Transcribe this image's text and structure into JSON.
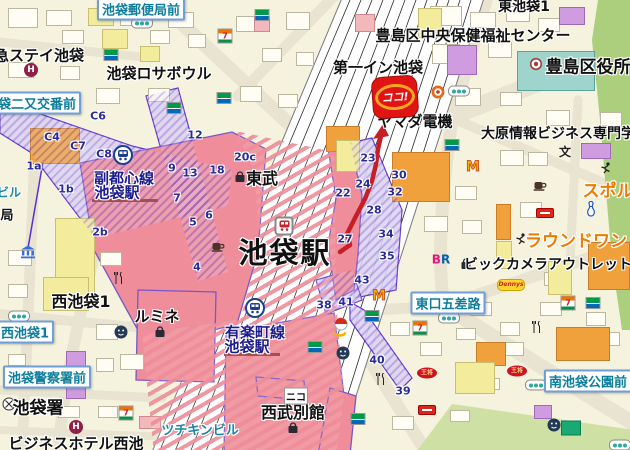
{
  "map": {
    "colors": {
      "route": "#c41f26",
      "marker_red": "#e01413",
      "station_pink": "#ef8e9a",
      "walkway_purple": "#5b2fd0",
      "road_sign_blue": "#6f9fd8",
      "sign_text": "#0c7d9c",
      "green_area": "#abcf7d",
      "orange_building": "#f0a13c"
    },
    "marker": {
      "label": "ココ!"
    },
    "route": {
      "color": "#c41f26",
      "points": "340,252 350,245 347,234 355,218 365,199 372,181 376,164 378,149 381,136",
      "arrow": "383,124 373,139 389,136"
    },
    "signboards": [
      {
        "t": "池袋郵便局前",
        "x": 141,
        "y": 9
      },
      {
        "t": "袋二又交番前",
        "x": 37,
        "y": 103
      },
      {
        "t": "西池袋1",
        "x": 25,
        "y": 332
      },
      {
        "t": "池袋警察署前",
        "x": 47,
        "y": 377
      },
      {
        "t": "東口五差路",
        "x": 448,
        "y": 303
      },
      {
        "t": "南池袋公園前",
        "x": 588,
        "y": 381
      }
    ],
    "labels": [
      {
        "t": "急ステイ池袋",
        "x": 39,
        "y": 55,
        "s": "b15",
        "id": "hotel-tokyu-stay-label"
      },
      {
        "t": "池袋ロサボウル",
        "x": 159,
        "y": 73,
        "s": "b15",
        "id": "rosa-bowl-label"
      },
      {
        "t": "第一イン池袋",
        "x": 378,
        "y": 67,
        "s": "b15",
        "id": "daiichi-inn-label"
      },
      {
        "t": "豊島区中央保健福祉センター",
        "x": 473,
        "y": 35,
        "s": "b15",
        "id": "health-center-label"
      },
      {
        "t": "東池袋1",
        "x": 524,
        "y": 6,
        "s": "b14",
        "id": "higashi-ikebukuro-label"
      },
      {
        "t": "豊島区役所",
        "x": 588,
        "y": 65,
        "s": "b17",
        "id": "toshima-ward-office-label"
      },
      {
        "t": "大原情報ビジネス専門学",
        "x": 558,
        "y": 133,
        "s": "b14",
        "id": "ohara-college-label"
      },
      {
        "t": "ヤマダ電機",
        "x": 415,
        "y": 121,
        "s": "b15",
        "id": "yamada-denki-label"
      },
      {
        "t": "東武",
        "x": 262,
        "y": 177,
        "s": "b16",
        "id": "tobu-label"
      },
      {
        "t": "池袋駅",
        "x": 285,
        "y": 251,
        "s": "xl",
        "id": "ikebukuro-station-label"
      },
      {
        "t": "副都心線",
        "x": 124,
        "y": 178,
        "s": "navy",
        "id": "fukutoshin-line-label"
      },
      {
        "t": "池袋駅",
        "x": 117,
        "y": 192,
        "s": "navy",
        "id": "fukutoshin-station-label"
      },
      {
        "t": "有楽町線",
        "x": 255,
        "y": 332,
        "s": "navy",
        "id": "yurakucho-line-label"
      },
      {
        "t": "池袋駅",
        "x": 247,
        "y": 346,
        "s": "navy",
        "id": "yurakucho-station-label"
      },
      {
        "t": "西池袋1",
        "x": 81,
        "y": 300,
        "s": "b16",
        "id": "nishi-ikebukuro-label"
      },
      {
        "t": "ルミネ",
        "x": 157,
        "y": 316,
        "s": "b15",
        "id": "lumine-label"
      },
      {
        "t": "西武別館",
        "x": 293,
        "y": 411,
        "s": "b16",
        "id": "seibu-annex-label"
      },
      {
        "t": "池袋署",
        "x": 38,
        "y": 406,
        "s": "b17",
        "id": "police-station-label"
      },
      {
        "t": "ビジネスホテル西池",
        "x": 76,
        "y": 443,
        "s": "b15",
        "id": "business-hotel-label"
      },
      {
        "t": "ツチキンビル",
        "x": 200,
        "y": 429,
        "s": "teal13",
        "id": "tsuchikin-bldg-label"
      },
      {
        "t": "ビル",
        "x": 9,
        "y": 192,
        "s": "teal12"
      },
      {
        "t": "局",
        "x": 7,
        "y": 214,
        "s": "b13"
      },
      {
        "t": "ニコ",
        "x": 296,
        "y": 396,
        "s": "chip"
      },
      {
        "t": "スポル",
        "x": 608,
        "y": 189,
        "s": "or17",
        "id": "sporto-label"
      },
      {
        "t": "ラウンドワン",
        "x": 576,
        "y": 239,
        "s": "or17",
        "id": "round-one-label"
      },
      {
        "t": "ビックカメラアウトレット",
        "x": 548,
        "y": 264,
        "s": "b14",
        "id": "bic-camera-outlet-label"
      }
    ],
    "exits": [
      {
        "t": "C6",
        "x": 98,
        "y": 116
      },
      {
        "t": "C4",
        "x": 52,
        "y": 137
      },
      {
        "t": "C7",
        "x": 78,
        "y": 146
      },
      {
        "t": "C8",
        "x": 104,
        "y": 154
      },
      {
        "t": "1a",
        "x": 34,
        "y": 166
      },
      {
        "t": "1b",
        "x": 66,
        "y": 189
      },
      {
        "t": "2b",
        "x": 100,
        "y": 232
      },
      {
        "t": "12",
        "x": 195,
        "y": 135
      },
      {
        "t": "9",
        "x": 172,
        "y": 168
      },
      {
        "t": "13",
        "x": 190,
        "y": 173
      },
      {
        "t": "7",
        "x": 177,
        "y": 198
      },
      {
        "t": "6",
        "x": 209,
        "y": 215
      },
      {
        "t": "5",
        "x": 193,
        "y": 222
      },
      {
        "t": "4",
        "x": 197,
        "y": 267
      },
      {
        "t": "18",
        "x": 217,
        "y": 170
      },
      {
        "t": "20c",
        "x": 245,
        "y": 157
      },
      {
        "t": "23",
        "x": 368,
        "y": 158
      },
      {
        "t": "24",
        "x": 363,
        "y": 184
      },
      {
        "t": "22",
        "x": 343,
        "y": 193
      },
      {
        "t": "28",
        "x": 374,
        "y": 210
      },
      {
        "t": "30",
        "x": 399,
        "y": 175
      },
      {
        "t": "32",
        "x": 395,
        "y": 192
      },
      {
        "t": "27",
        "x": 345,
        "y": 239
      },
      {
        "t": "34",
        "x": 386,
        "y": 234
      },
      {
        "t": "35",
        "x": 387,
        "y": 256
      },
      {
        "t": "43",
        "x": 362,
        "y": 280
      },
      {
        "t": "41",
        "x": 346,
        "y": 302
      },
      {
        "t": "38",
        "x": 324,
        "y": 305
      },
      {
        "t": "40",
        "x": 377,
        "y": 360
      },
      {
        "t": "39",
        "x": 403,
        "y": 391
      }
    ],
    "icons": [
      {
        "type": "traffic-signal",
        "x": 142,
        "y": 23
      },
      {
        "type": "traffic-signal",
        "x": 19,
        "y": 316
      },
      {
        "type": "traffic-signal",
        "x": 459,
        "y": 91
      },
      {
        "type": "traffic-signal",
        "x": 449,
        "y": 318
      },
      {
        "type": "traffic-signal",
        "x": 536,
        "y": 385
      },
      {
        "type": "traffic-signal",
        "x": 620,
        "y": 445
      },
      {
        "type": "seven-eleven",
        "x": 225,
        "y": 36
      },
      {
        "type": "seven-eleven",
        "x": 568,
        "y": 303
      },
      {
        "type": "seven-eleven",
        "x": 420,
        "y": 328
      },
      {
        "type": "seven-eleven",
        "x": 126,
        "y": 413
      },
      {
        "type": "familymart",
        "x": 111,
        "y": 55
      },
      {
        "type": "familymart",
        "x": 174,
        "y": 108
      },
      {
        "type": "familymart",
        "x": 262,
        "y": 15
      },
      {
        "type": "familymart",
        "x": 224,
        "y": 98
      },
      {
        "type": "familymart",
        "x": 452,
        "y": 145
      },
      {
        "type": "familymart",
        "x": 315,
        "y": 347
      },
      {
        "type": "familymart",
        "x": 372,
        "y": 316
      },
      {
        "type": "familymart",
        "x": 358,
        "y": 419
      },
      {
        "type": "familymart",
        "x": 593,
        "y": 303
      },
      {
        "type": "mcdonalds",
        "x": 379,
        "y": 296
      },
      {
        "type": "mcdonalds",
        "x": 473,
        "y": 167
      },
      {
        "type": "metro-station",
        "x": 123,
        "y": 155
      },
      {
        "type": "metro-station",
        "x": 255,
        "y": 308
      },
      {
        "type": "jr-station",
        "x": 284,
        "y": 226
      },
      {
        "type": "department-store-bag",
        "x": 240,
        "y": 177
      },
      {
        "type": "department-store-bag",
        "x": 160,
        "y": 332
      },
      {
        "type": "department-store-bag",
        "x": 466,
        "y": 264
      },
      {
        "type": "department-store-bag",
        "x": 293,
        "y": 428
      },
      {
        "type": "hotel",
        "x": 31,
        "y": 70
      },
      {
        "type": "hotel",
        "x": 76,
        "y": 427
      },
      {
        "type": "police",
        "x": 9,
        "y": 404
      },
      {
        "type": "government-office",
        "x": 536,
        "y": 64
      },
      {
        "type": "bank",
        "x": 28,
        "y": 252
      },
      {
        "type": "school-symbol",
        "x": 565,
        "y": 152
      },
      {
        "type": "coffee-shop",
        "x": 218,
        "y": 247
      },
      {
        "type": "coffee-shop",
        "x": 540,
        "y": 186
      },
      {
        "type": "restaurant-fork",
        "x": 119,
        "y": 278
      },
      {
        "type": "restaurant-fork",
        "x": 537,
        "y": 327
      },
      {
        "type": "restaurant-fork",
        "x": 381,
        "y": 379
      },
      {
        "type": "restaurant-face",
        "x": 121,
        "y": 332
      },
      {
        "type": "restaurant-face",
        "x": 343,
        "y": 353
      },
      {
        "type": "restaurant-face",
        "x": 554,
        "y": 425
      },
      {
        "type": "shop-donut",
        "x": 438,
        "y": 92
      },
      {
        "type": "shop-red-circle",
        "x": 341,
        "y": 324
      },
      {
        "type": "shop-yellow-arc",
        "x": 340,
        "y": 335
      },
      {
        "type": "gyoza-restaurant",
        "x": 427,
        "y": 373
      },
      {
        "type": "gyoza-restaurant",
        "x": 517,
        "y": 371
      },
      {
        "type": "red-shop-sign",
        "x": 545,
        "y": 213
      },
      {
        "type": "red-shop-sign",
        "x": 427,
        "y": 410
      },
      {
        "type": "dennys",
        "x": 511,
        "y": 285
      },
      {
        "type": "baskin-robbins",
        "x": 441,
        "y": 259
      },
      {
        "type": "bowling-pin",
        "x": 591,
        "y": 209
      },
      {
        "type": "sports-person",
        "x": 521,
        "y": 239
      },
      {
        "type": "sports-person",
        "x": 606,
        "y": 168
      },
      {
        "type": "green-store",
        "x": 571,
        "y": 428
      }
    ]
  }
}
